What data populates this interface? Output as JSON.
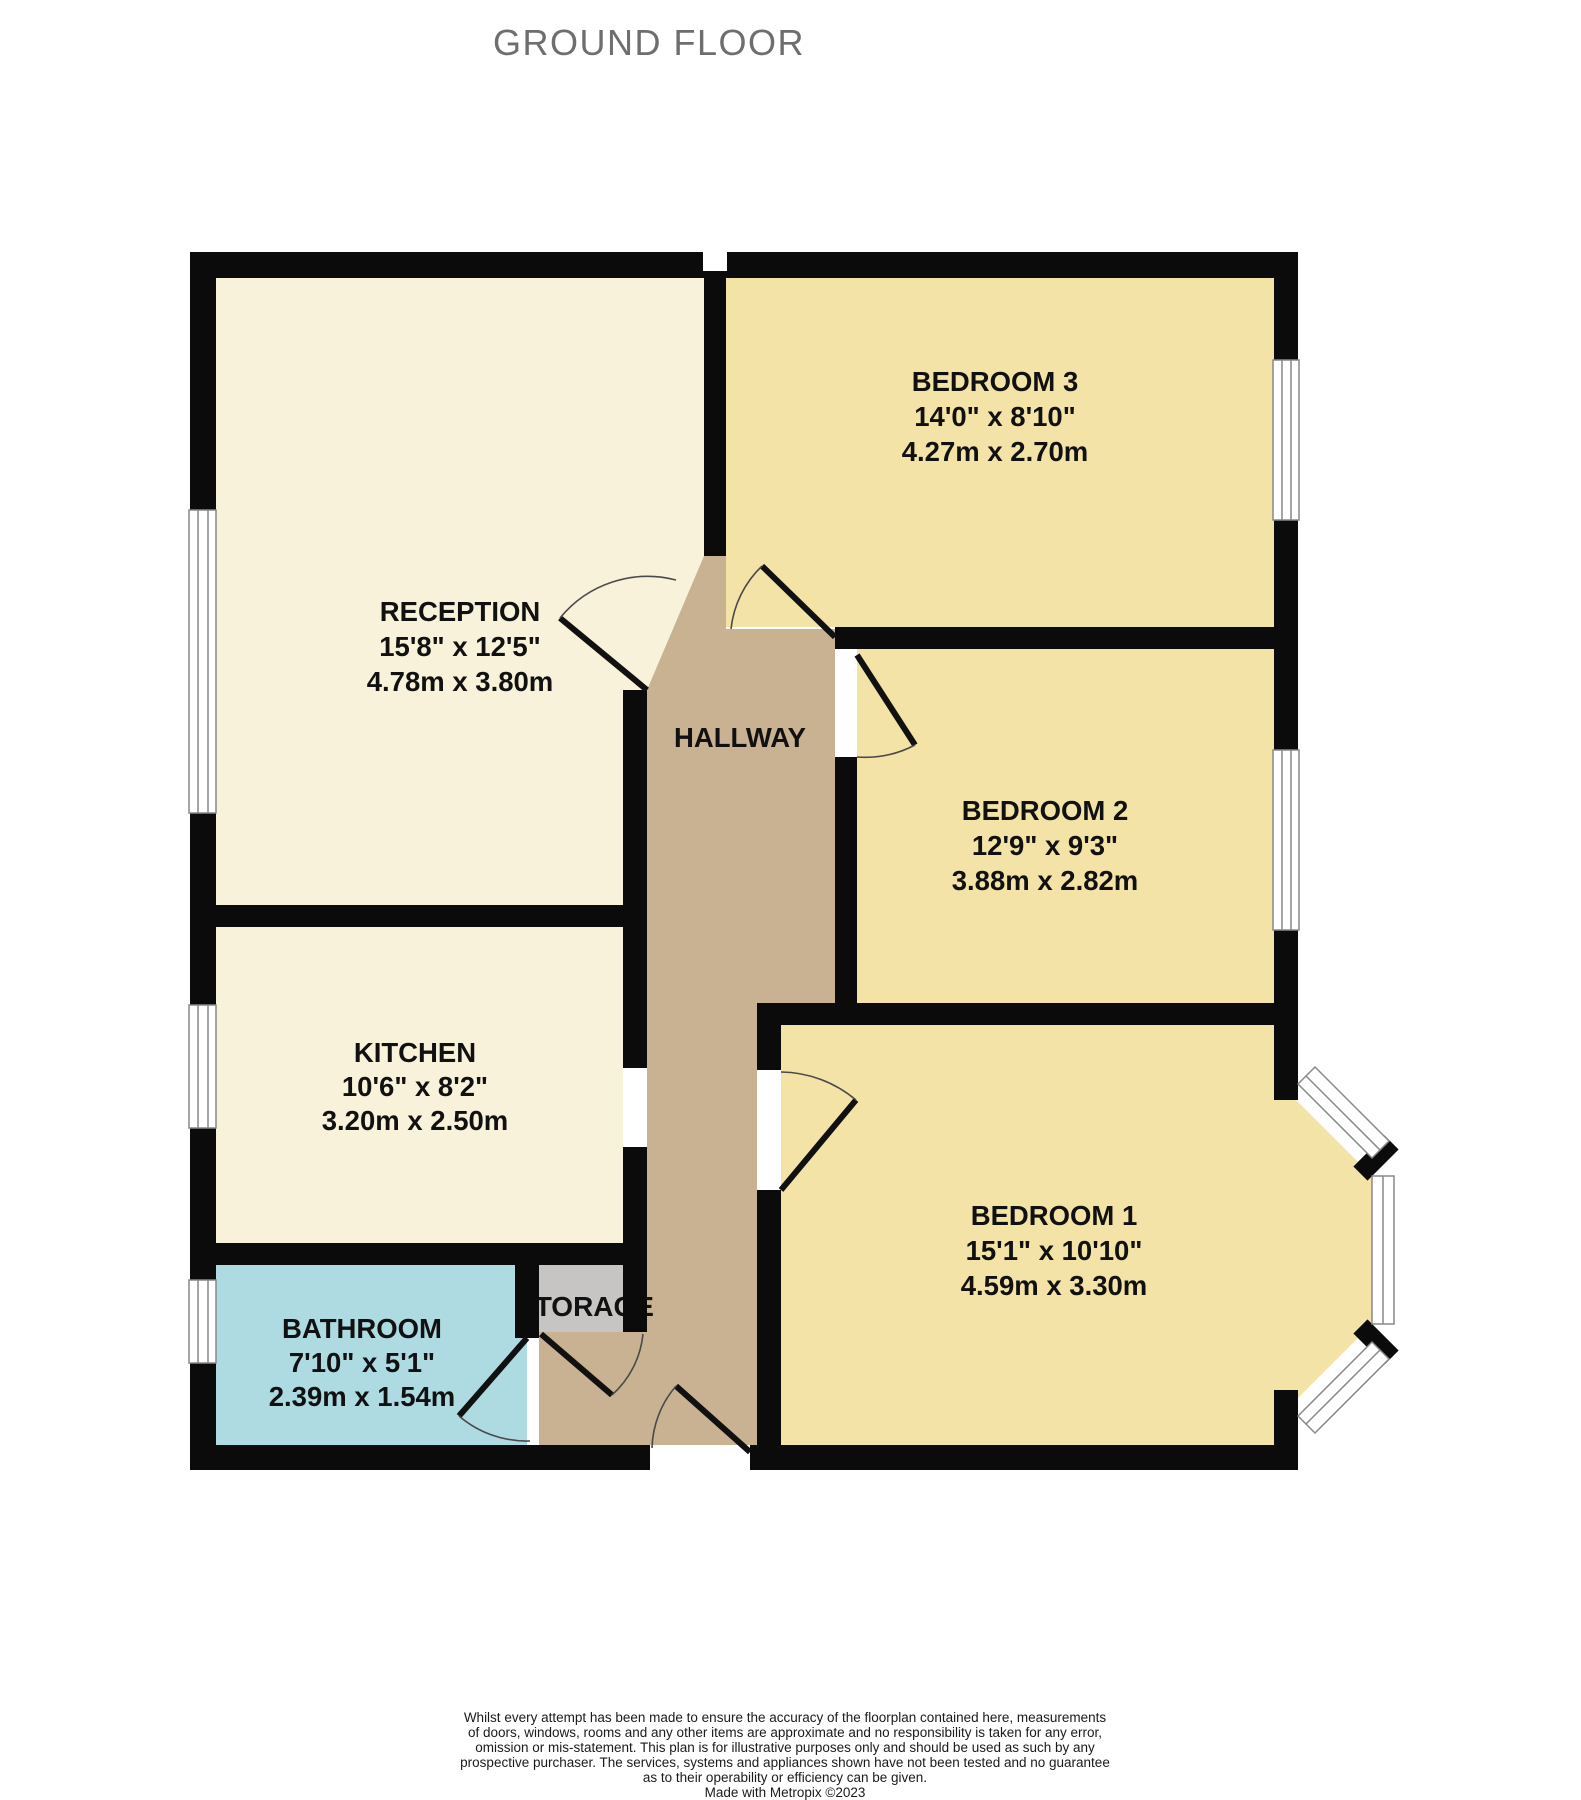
{
  "title": "GROUND FLOOR",
  "colors": {
    "reception_kitchen_fill": "#F8F2DA",
    "bedroom_fill": "#F4E3A7",
    "hallway_fill": "#C8B291",
    "bathroom_fill": "#AEDAE2",
    "storage_fill": "#C6C5C3",
    "wall": "#0B0B0B",
    "title_gray": "#6E6E6E"
  },
  "rooms": [
    {
      "id": "reception",
      "name": "RECEPTION",
      "imperial": "15'8\"  x 12'5\"",
      "metric": "4.78m  x 3.80m"
    },
    {
      "id": "bedroom3",
      "name": "BEDROOM 3",
      "imperial": "14'0\"  x 8'10\"",
      "metric": "4.27m  x 2.70m"
    },
    {
      "id": "bedroom2",
      "name": "BEDROOM 2",
      "imperial": "12'9\"  x 9'3\"",
      "metric": "3.88m  x 2.82m"
    },
    {
      "id": "bedroom1",
      "name": "BEDROOM 1",
      "imperial": "15'1\"  x 10'10\"",
      "metric": "4.59m  x 3.30m"
    },
    {
      "id": "kitchen",
      "name": "KITCHEN",
      "imperial": "10'6\"  x 8'2\"",
      "metric": "3.20m  x 2.50m"
    },
    {
      "id": "bathroom",
      "name": "BATHROOM",
      "imperial": "7'10\"  x 5'1\"",
      "metric": "2.39m  x 1.54m"
    }
  ],
  "hallway": {
    "label": "HALLWAY"
  },
  "storage": {
    "label": "STORAGE"
  },
  "footer": {
    "lines": [
      "Whilst every attempt has been made to ensure the accuracy of the floorplan contained here, measurements",
      "of doors, windows, rooms and any other items are approximate and no responsibility is taken for any error,",
      "omission or mis-statement. This plan is for illustrative purposes only and should be used as such by any",
      "prospective purchaser. The services, systems and appliances shown have not been tested and no guarantee",
      "as to their operability or efficiency can be given.",
      "Made with Metropix ©2023"
    ]
  }
}
